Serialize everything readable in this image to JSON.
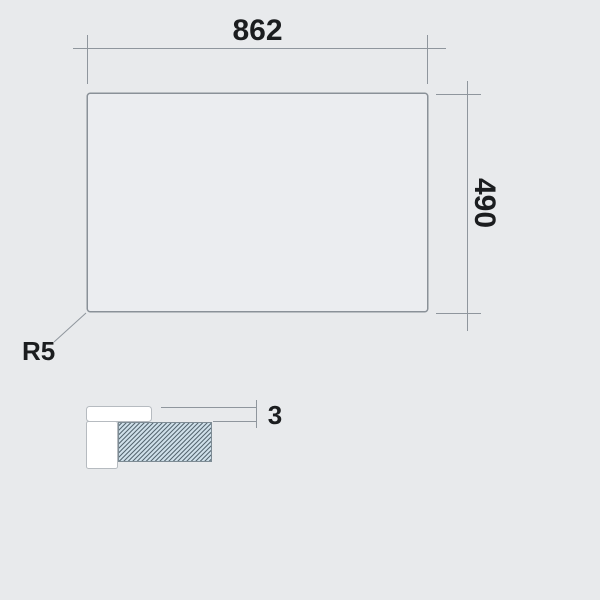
{
  "title": "Panel technical drawing with section detail",
  "colors": {
    "bg": "#e8eaec",
    "panel_fill": "#ebedf0",
    "panel_border": "#8a9198",
    "line": "#8f969d",
    "text": "#1b1d1f",
    "profile_fill": "#ffffff",
    "profile_border": "#b6bbc0",
    "hatch_fill": "#cfe0ea",
    "hatch_line": "#51626c",
    "hatch_border": "#7e8c95"
  },
  "top_view": {
    "width_dim": "862",
    "height_dim": "490",
    "radius_label": "R5"
  },
  "section_detail": {
    "thickness_dim": "3"
  }
}
